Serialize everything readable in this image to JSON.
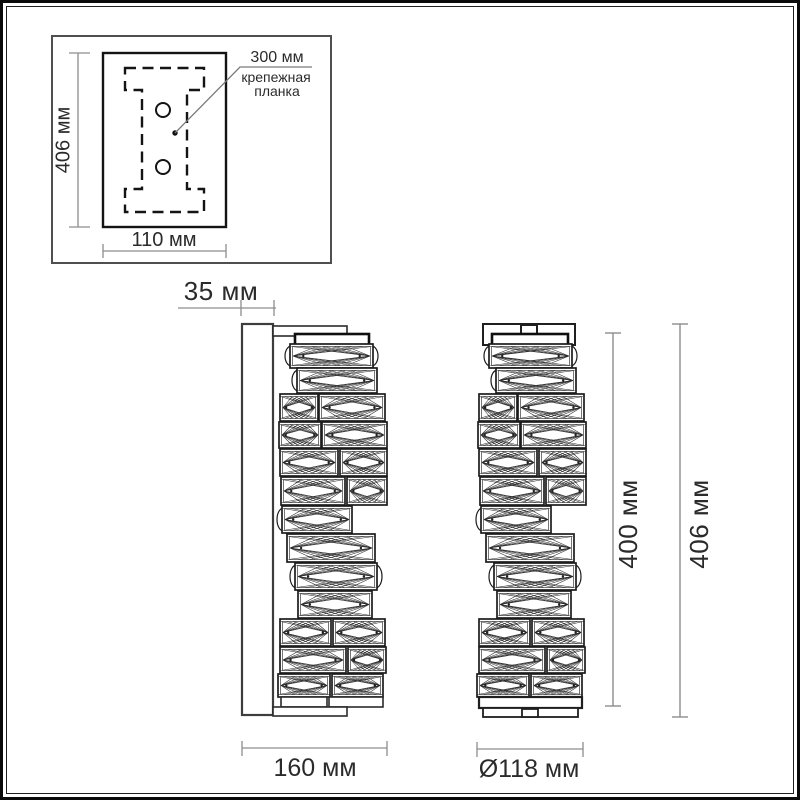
{
  "drawing": {
    "detail_box": {
      "height_label": "406 мм",
      "width_label": "110 мм",
      "callout_value": "300 мм",
      "callout_caption_line1": "крепежная",
      "callout_caption_line2": "планка"
    },
    "side_view": {
      "depth_label": "35 мм",
      "width_label": "160 мм"
    },
    "front_view": {
      "lamp_height_label": "400 мм",
      "overall_height_label": "406 мм",
      "diameter_label": "Ø118 мм"
    }
  },
  "colors": {
    "background": "#ffffff",
    "frame": "#0a0a0a",
    "outline": "#1f1f1f",
    "wall_plate": "#3d3d3d",
    "dimension_line": "#8d8d8d",
    "text": "#2b2b2b"
  }
}
